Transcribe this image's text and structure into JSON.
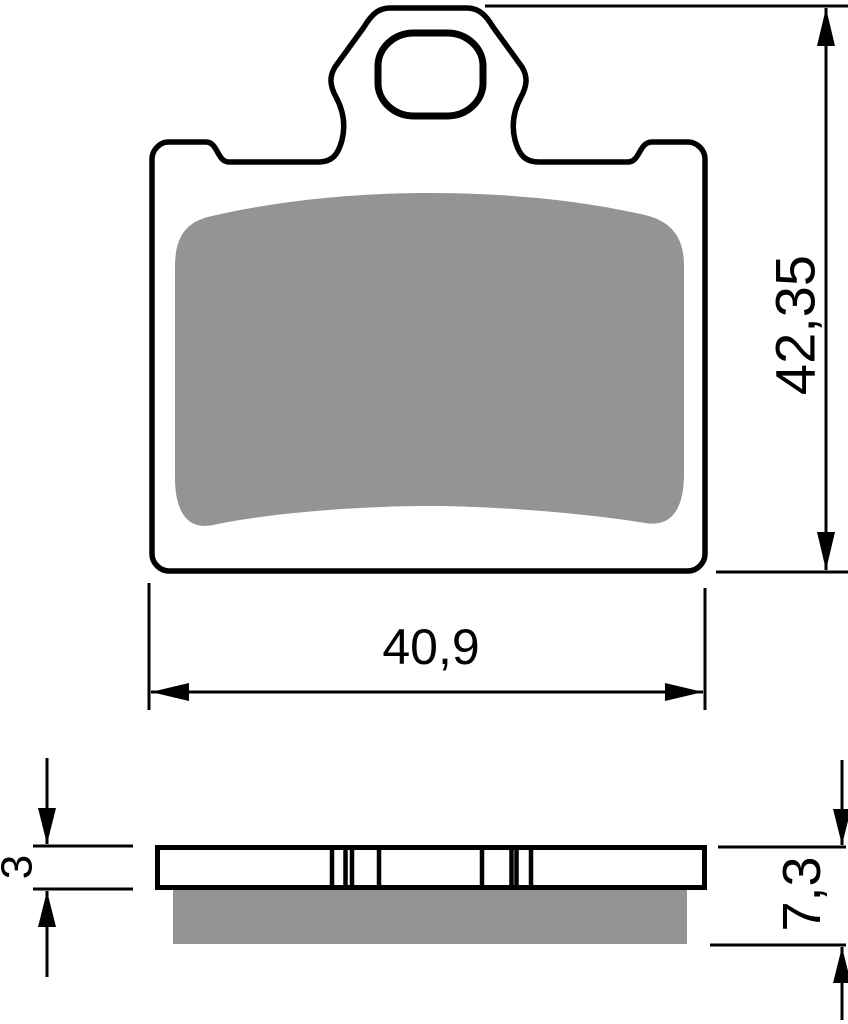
{
  "drawing": {
    "title": "brake-pad-technical-drawing",
    "front_view": {
      "width_dimension": "40,9",
      "height_dimension": "42,35"
    },
    "side_view": {
      "plate_thickness_dimension": "3",
      "total_thickness_dimension": "7,3"
    },
    "colors": {
      "line": "#000000",
      "friction_material": "#949494",
      "background": "#ffffff"
    }
  }
}
